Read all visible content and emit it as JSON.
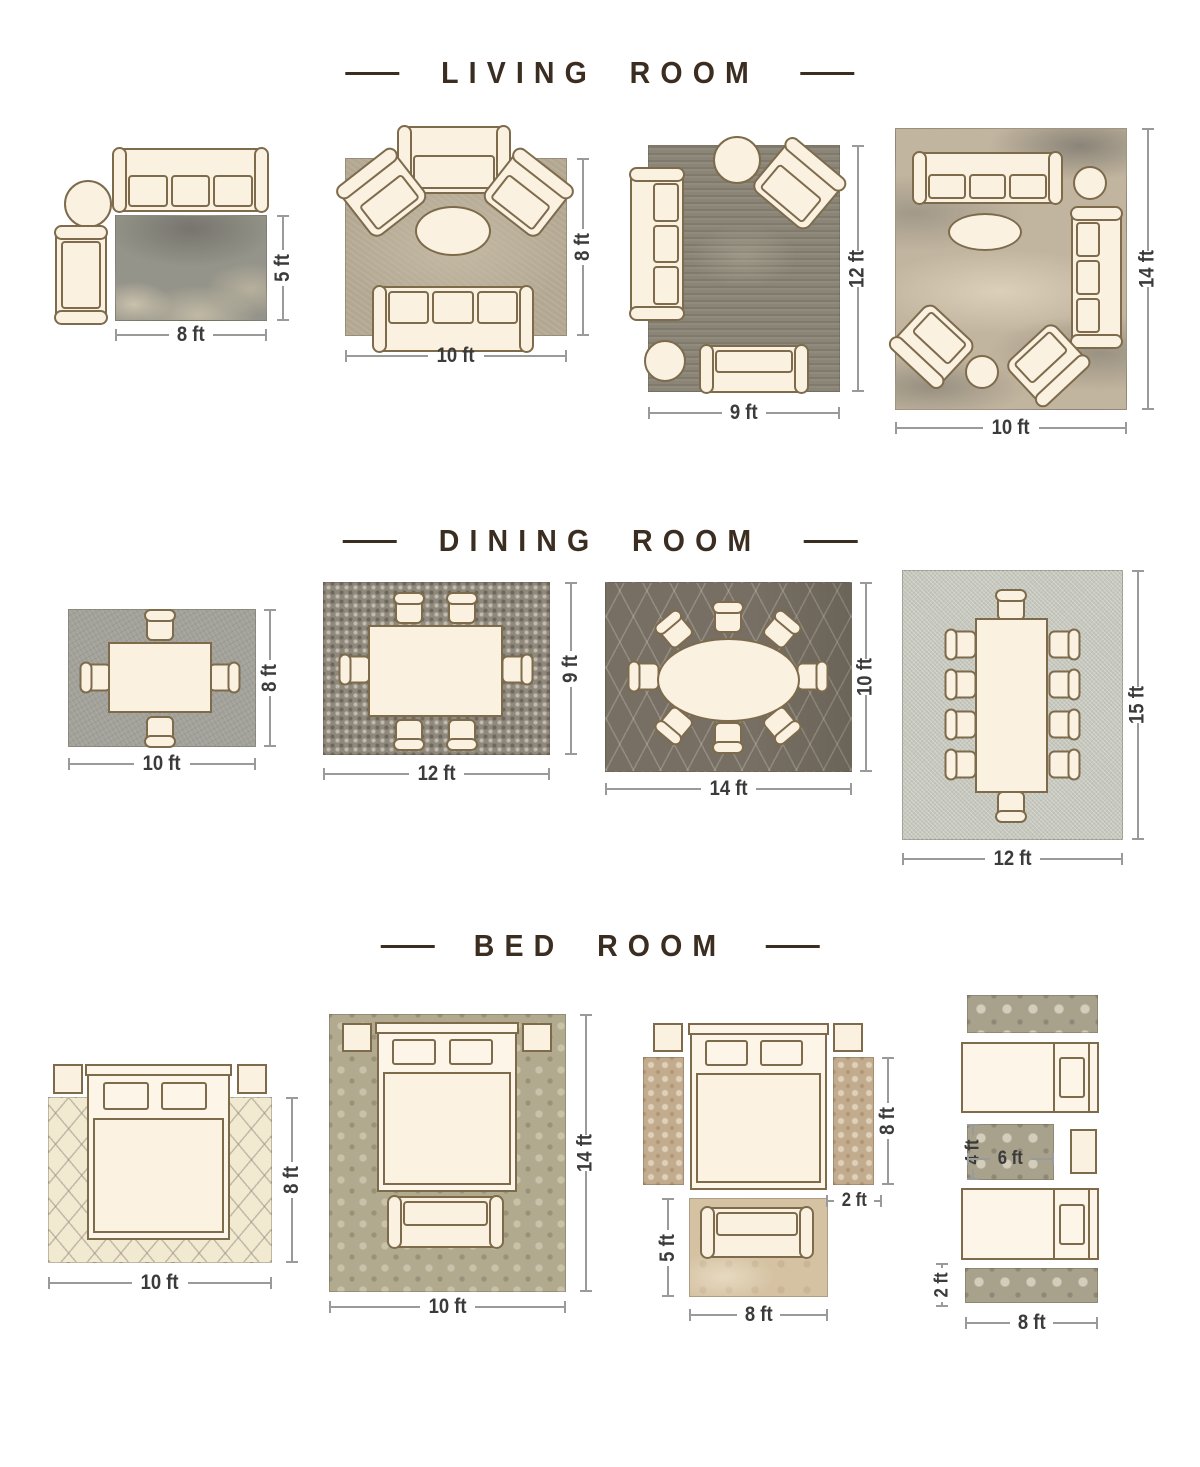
{
  "colors": {
    "title": "#3c2d21",
    "dimension_text": "#3b3b3b",
    "dimension_line": "#9a9a9a",
    "furniture_fill": "#faf1e1",
    "furniture_outline": "#7d6b4c"
  },
  "sections": {
    "living": {
      "title": "LIVING ROOM",
      "layouts": [
        {
          "width_label": "8 ft",
          "height_label": "5 ft"
        },
        {
          "width_label": "10 ft",
          "height_label": "8 ft"
        },
        {
          "width_label": "9 ft",
          "height_label": "12 ft"
        },
        {
          "width_label": "10 ft",
          "height_label": "14 ft"
        }
      ]
    },
    "dining": {
      "title": "DINING ROOM",
      "layouts": [
        {
          "width_label": "10 ft",
          "height_label": "8 ft"
        },
        {
          "width_label": "12 ft",
          "height_label": "9 ft"
        },
        {
          "width_label": "14 ft",
          "height_label": "10 ft"
        },
        {
          "width_label": "12 ft",
          "height_label": "15 ft"
        }
      ]
    },
    "bedroom": {
      "title": "BED ROOM",
      "layouts": [
        {
          "width_label": "10 ft",
          "height_label": "8 ft"
        },
        {
          "width_label": "10 ft",
          "height_label": "14 ft"
        },
        {
          "foot_width_label": "8 ft",
          "foot_height_label": "5 ft",
          "runner_length_label": "8 ft",
          "runner_width_label": "2 ft"
        },
        {
          "runner_width_label": "8 ft",
          "runner_height_label": "2 ft",
          "small_rug_width_label": "6 ft",
          "small_rug_height_label": "4 ft"
        }
      ]
    }
  }
}
